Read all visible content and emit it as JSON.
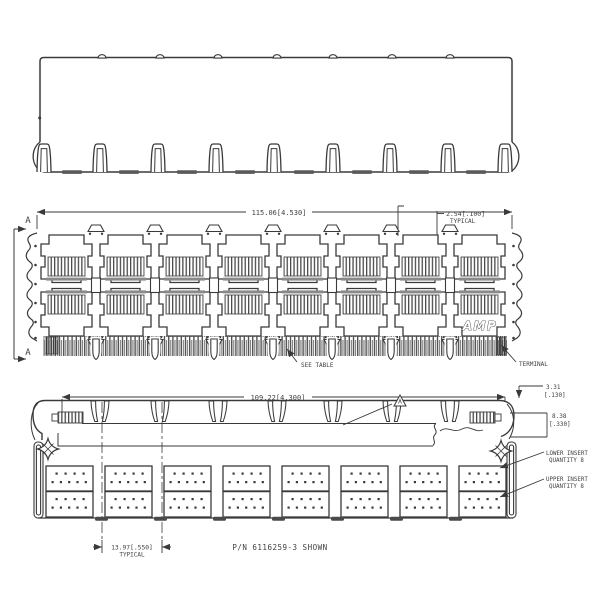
{
  "title": "connector engineering drawing",
  "section": {
    "label": "A"
  },
  "middle": {
    "dim_overall": "115.06[4.530]",
    "pitch": "2.54[.100]",
    "pitch_qual": "TYPICAL",
    "see_table": "SEE TABLE",
    "terminal": "TERMINAL",
    "brand": "AMP"
  },
  "bottom": {
    "dim_overall": "109.22[4.300]",
    "h1_mm": "3.31",
    "h1_in": "[.130]",
    "h2_mm": "8.38",
    "h2_in": "[.330]",
    "lower1": "LOWER INSERT",
    "lower2": "QUANTITY 8",
    "upper1": "UPPER INSERT",
    "upper2": "QUANTITY 8",
    "pitch": "13.97[.550]",
    "pitch_qual": "TYPICAL",
    "part_note": "P/N 6116259-3 SHOWN"
  },
  "colors": {
    "line": "#3a3a3a",
    "text": "#3f3f3f",
    "background": "#ffffff"
  }
}
